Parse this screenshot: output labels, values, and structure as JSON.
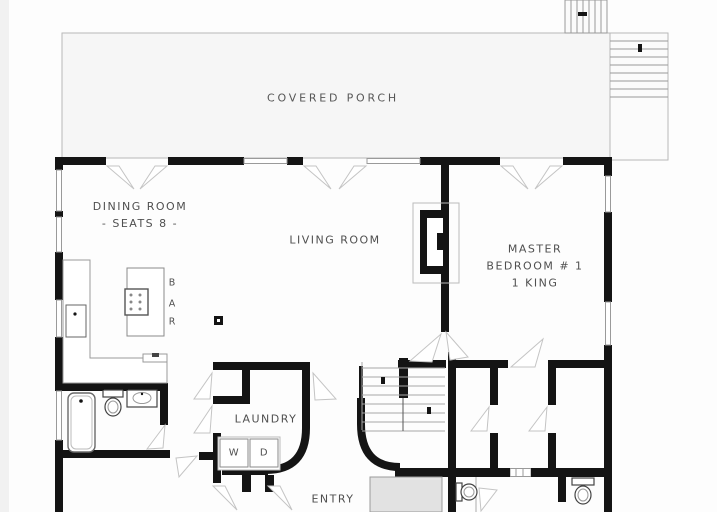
{
  "rooms": {
    "covered_porch": "COVERED PORCH",
    "dining_room": {
      "name": "DINING ROOM",
      "note": "- SEATS 8 -"
    },
    "living_room": {
      "name": "LIVING ROOM"
    },
    "master_bedroom": {
      "line1": "MASTER",
      "line2": "BEDROOM # 1",
      "line3": "1 KING"
    },
    "bar": {
      "letters": [
        "B",
        "A",
        "R"
      ]
    },
    "laundry": {
      "name": "LAUNDRY",
      "washer": "W",
      "dryer": "D"
    },
    "entry": {
      "name": "ENTRY"
    }
  },
  "colors": {
    "wall": "#141414",
    "porch_fill": "#f6f6f6",
    "thin_line": "#9a9a9a",
    "swing_line": "#c4c4c4",
    "text": "#4f4f4f",
    "shade_fill": "#e2e2e2"
  },
  "icons": [
    "staircase",
    "exterior-stairs",
    "fireplace",
    "bathtub",
    "toilet",
    "sink",
    "kitchen-sink",
    "cooktop",
    "kitchen-island",
    "washer",
    "dryer",
    "door-swing",
    "window",
    "floor-outlet",
    "shower-pad"
  ]
}
